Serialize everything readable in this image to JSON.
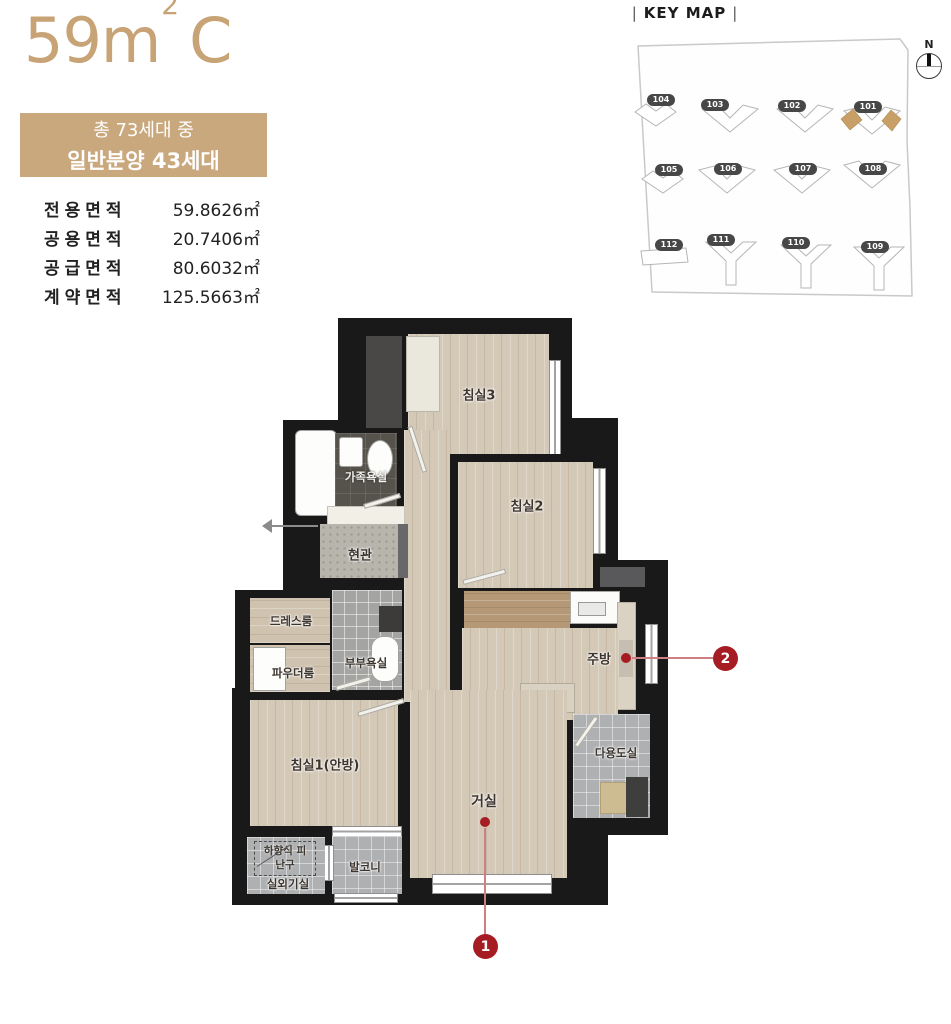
{
  "unit": {
    "title_main": "59m",
    "title_sup": "2",
    "title_type": "C",
    "badge_line1": "총 73세대 중",
    "badge_line2": "일반분양 43세대"
  },
  "areas": [
    {
      "label": "전용면적",
      "value": "59.8626㎡"
    },
    {
      "label": "공용면적",
      "value": "20.7406㎡"
    },
    {
      "label": "공급면적",
      "value": "80.6032㎡"
    },
    {
      "label": "계약면적",
      "value": "125.5663㎡"
    }
  ],
  "keymap": {
    "title": "KEY MAP",
    "separator": "|",
    "compass_label": "N",
    "buildings": [
      "104",
      "103",
      "102",
      "101",
      "105",
      "106",
      "107",
      "108",
      "112",
      "111",
      "110",
      "109"
    ],
    "highlighted_building": "101"
  },
  "floorplan": {
    "rooms": {
      "bedroom3": "침실3",
      "bedroom2": "침실2",
      "family_bath": "가족욕실",
      "entrance": "현관",
      "dress_room": "드레스룸",
      "powder_room": "파우더룸",
      "master_bath": "부부욕실",
      "kitchen": "주방",
      "bedroom1": "침실1(안방)",
      "living": "거실",
      "utility": "다용도실",
      "balcony": "발코니",
      "evac_hatch": "하향식 피난구",
      "outdoor_unit": "실외기실"
    },
    "markers": [
      {
        "number": "1"
      },
      {
        "number": "2"
      }
    ]
  },
  "colors": {
    "accent_gold": "#c8a87c",
    "title_gold": "#c7a376",
    "marker_red": "#a61c23",
    "wall": "#191919",
    "highlight_unit": "#c8a067"
  }
}
